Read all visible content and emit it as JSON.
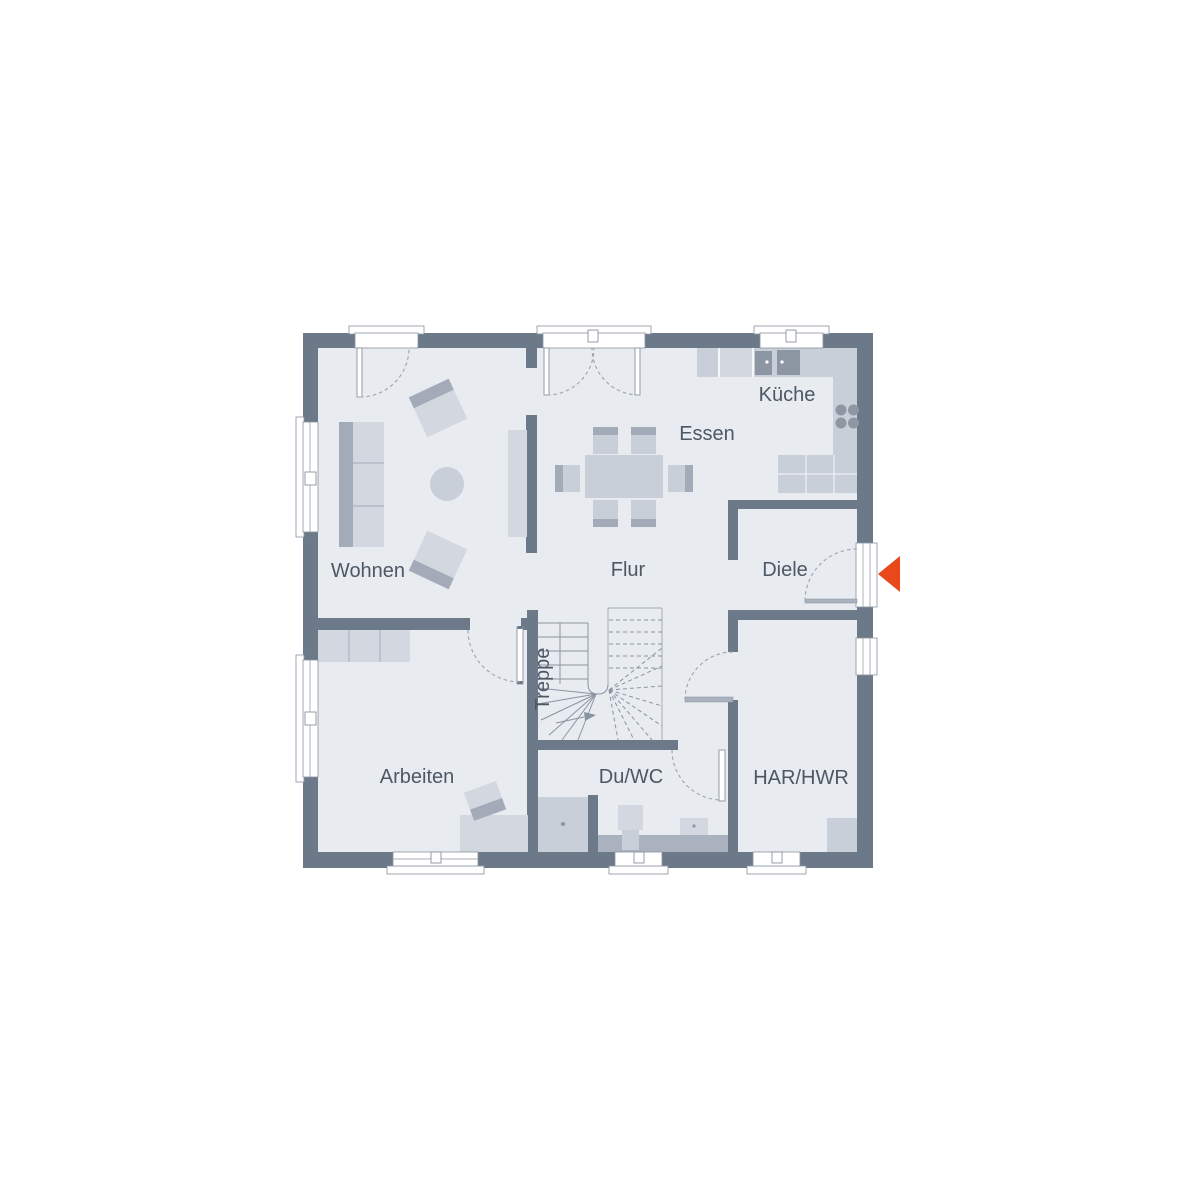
{
  "colors": {
    "wall": "#6b7989",
    "floor": "#e8ebf0",
    "furnLight": "#d2d7e0",
    "furnMid": "#c9cfd8",
    "furnDark": "#a2abb7",
    "fixture": "#8d97a4",
    "band": "#a9b2be",
    "line": "#8a94a1",
    "arc": "#9aa3af",
    "label": "#4d5865",
    "accent": "#e8481a",
    "paper": "#ffffff"
  },
  "rooms": {
    "wohnen": {
      "label": "Wohnen"
    },
    "essen": {
      "label": "Essen"
    },
    "kueche": {
      "label": "Küche"
    },
    "flur": {
      "label": "Flur"
    },
    "diele": {
      "label": "Diele"
    },
    "treppe": {
      "label": "Treppe"
    },
    "arbeiten": {
      "label": "Arbeiten"
    },
    "duwc": {
      "label": "Du/WC"
    },
    "harhwr": {
      "label": "HAR/HWR"
    }
  }
}
